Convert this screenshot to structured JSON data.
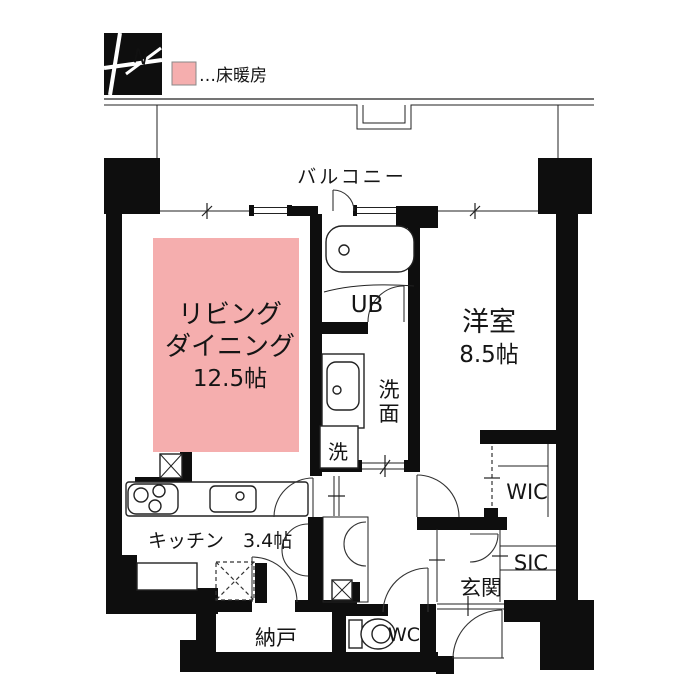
{
  "colors": {
    "floor_heating": "#f5aeae",
    "wall": "#0e0e0e",
    "line": "#222222",
    "background": "#ffffff"
  },
  "compass": {
    "label": "N"
  },
  "legend": {
    "floor_heating_label": "…床暖房"
  },
  "balcony": {
    "label": "バルコニー"
  },
  "rooms": {
    "living_dining": {
      "line1": "リビング",
      "line2": "ダイニング",
      "size": "12.5帖"
    },
    "kitchen": {
      "label": "キッチン　3.4帖"
    },
    "western": {
      "name": "洋室",
      "size": "8.5帖"
    },
    "unit_bath": {
      "label": "UB"
    },
    "washroom": {
      "char1": "洗",
      "char2": "面"
    },
    "laundry": {
      "label": "洗"
    },
    "wic": {
      "label": "WIC"
    },
    "sic": {
      "label": "SIC"
    },
    "entrance": {
      "label": "玄関"
    },
    "storage": {
      "label": "納戸"
    },
    "wc": {
      "label": "WC"
    }
  }
}
